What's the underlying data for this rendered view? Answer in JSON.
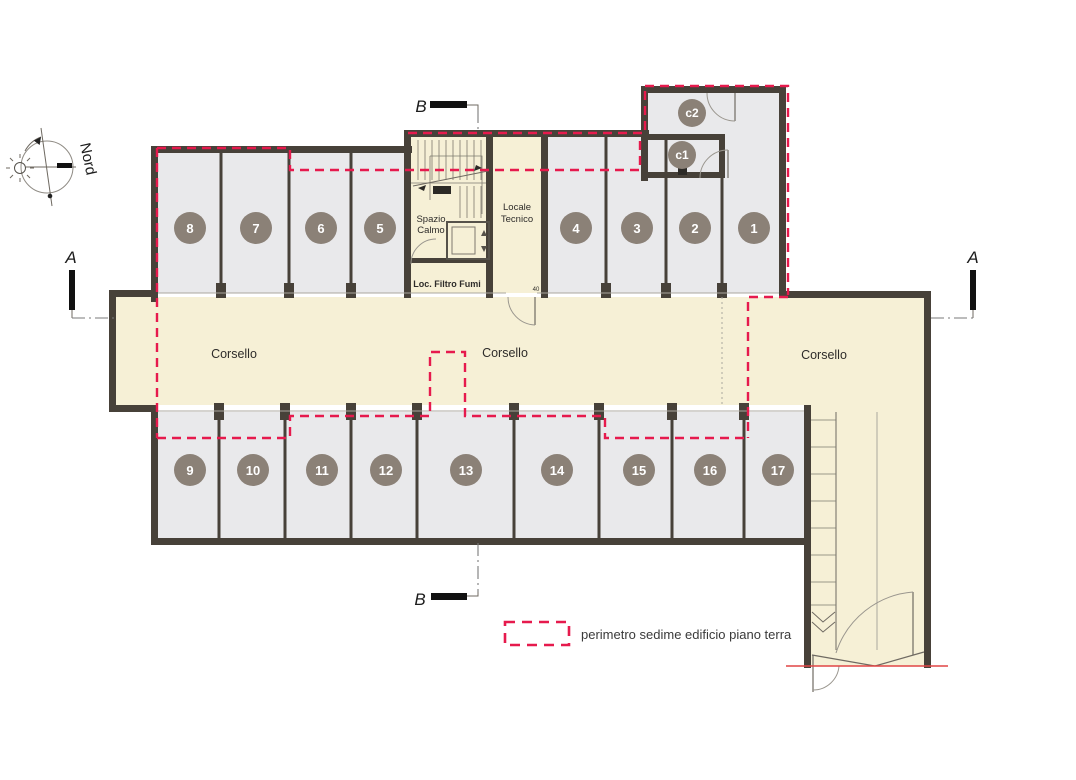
{
  "compass": {
    "label": "Nord"
  },
  "markers": {
    "a": "A",
    "b": "B"
  },
  "corridor_labels": [
    "Corsello",
    "Corsello",
    "Corsello"
  ],
  "rooms": {
    "spazio_calmo_line1": "Spazio",
    "spazio_calmo_line2": "Calmo",
    "locale_tecnico_line1": "Locale",
    "locale_tecnico_line2": "Tecnico",
    "filtro_fumi": "Loc. Filtro Fumi",
    "dim_note": "40"
  },
  "stalls": [
    "1",
    "2",
    "3",
    "4",
    "5",
    "6",
    "7",
    "8",
    "9",
    "10",
    "11",
    "12",
    "13",
    "14",
    "15",
    "16",
    "17"
  ],
  "cellars": {
    "c1": "c1",
    "c2": "c2"
  },
  "legend": {
    "label": "perimetro sedime edificio piano terra"
  },
  "colors": {
    "wall": "#474139",
    "stall_fill": "#e9e9eb",
    "court_fill": "#f6f0d6",
    "perimeter_red": "#e61a4d",
    "badge": "#8b8177"
  }
}
